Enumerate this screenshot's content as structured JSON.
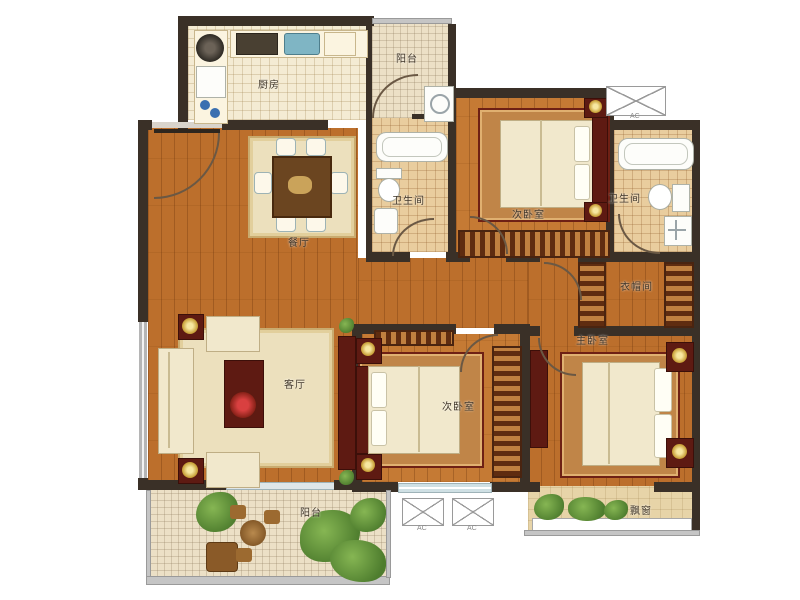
{
  "rooms": {
    "kitchen": {
      "label": "厨房"
    },
    "balcony_top": {
      "label": "阳台"
    },
    "bath_1": {
      "label": "卫生间"
    },
    "bedroom_top": {
      "label": "次卧室"
    },
    "bath_2": {
      "label": "卫生间"
    },
    "cloakroom": {
      "label": "衣帽间"
    },
    "dining": {
      "label": "餐厅"
    },
    "living": {
      "label": "客厅"
    },
    "bedroom_bottom": {
      "label": "次卧室"
    },
    "master_bedroom": {
      "label": "主卧室"
    },
    "bay_window": {
      "label": "飘窗"
    },
    "balcony_bottom": {
      "label": "阳台"
    }
  },
  "ac": {
    "label": "AC"
  },
  "colors": {
    "wall": "#3a3027",
    "wood_floor": "#bc6f2c",
    "kitchen_tile": "#f4ebd3",
    "bath_tile": "#e9cd9e",
    "furniture_dark_red": "#5e1a12",
    "bed_cream": "#f1e8cc",
    "plant_green": "#4e7d2e"
  }
}
